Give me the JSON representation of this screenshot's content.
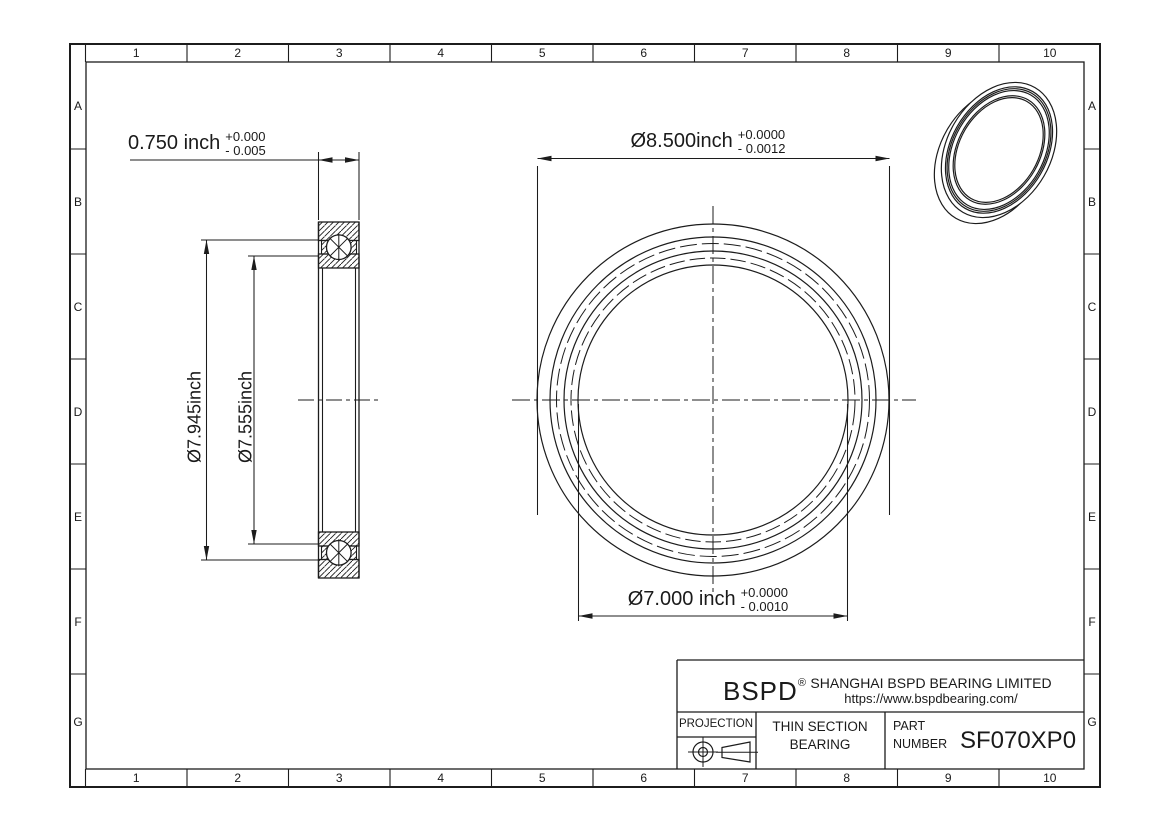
{
  "drawing": {
    "grid": {
      "cols": [
        "1",
        "2",
        "3",
        "4",
        "5",
        "6",
        "7",
        "8",
        "9",
        "10"
      ],
      "rows": [
        "A",
        "B",
        "C",
        "D",
        "E",
        "F",
        "G"
      ]
    },
    "dims": {
      "section_width": {
        "value": "0.750 inch",
        "tol_plus": "+0.000",
        "tol_minus": "- 0.005"
      },
      "outer_race": {
        "value": "Ø7.945inch"
      },
      "inner_race": {
        "value": "Ø7.555inch"
      },
      "outer_diameter": {
        "value": "Ø8.500inch",
        "tol_plus": "+0.0000",
        "tol_minus": "- 0.0012"
      },
      "bore_diameter": {
        "value": "Ø7.000 inch",
        "tol_plus": "+0.0000",
        "tol_minus": "- 0.0010"
      }
    },
    "title_block": {
      "brand": "BSPD",
      "registered": "®",
      "company": "SHANGHAI BSPD BEARING LIMITED",
      "website": "https://www.bspdbearing.com/",
      "projection_label": "PROJECTION",
      "product_line1": "THIN SECTION",
      "product_line2": "BEARING",
      "part_label1": "PART",
      "part_label2": "NUMBER",
      "part_number": "SF070XP0"
    },
    "colors": {
      "line": "#1c1c1c",
      "background": "#ffffff"
    }
  }
}
